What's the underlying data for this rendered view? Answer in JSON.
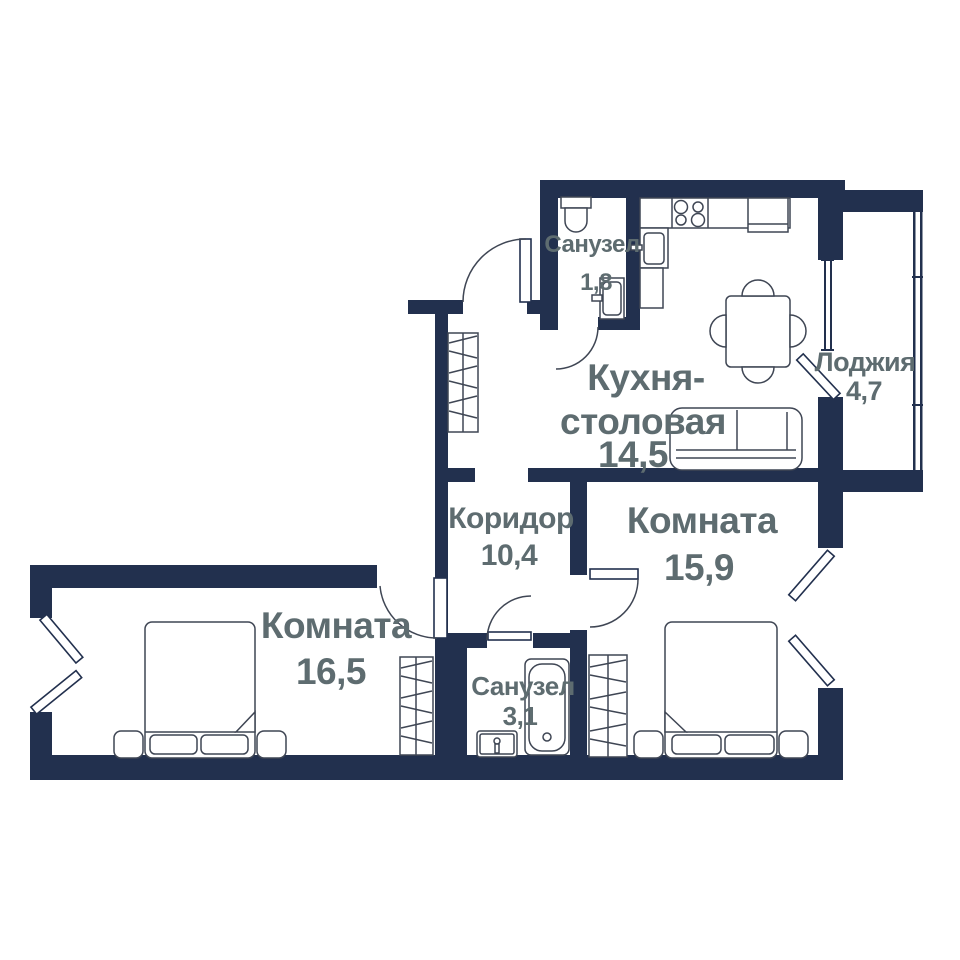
{
  "colors": {
    "wall": "#22304e",
    "label": "#5e6c70",
    "background": "#ffffff",
    "furniture_line": "#3f4654"
  },
  "rooms": [
    {
      "id": "bathroom-top",
      "name": "Санузел",
      "area": "1,8"
    },
    {
      "id": "kitchen-dining",
      "name": "Кухня-столовая",
      "name_lines": [
        "Кухня-",
        "столовая"
      ],
      "area": "14,5"
    },
    {
      "id": "loggia",
      "name": "Лоджия",
      "area": "4,7"
    },
    {
      "id": "corridor",
      "name": "Коридор",
      "area": "10,4"
    },
    {
      "id": "room-right",
      "name": "Комната",
      "area": "15,9"
    },
    {
      "id": "room-left",
      "name": "Комната",
      "area": "16,5"
    },
    {
      "id": "bathroom-bottom",
      "name": "Санузел",
      "area": "3,1"
    }
  ],
  "icons": [
    "toilet-icon",
    "washbasin-icon",
    "stove-icon",
    "fridge-icon",
    "kitchen-sink-icon",
    "dining-table-icon",
    "chair-icon",
    "sofa-icon",
    "wardrobe-icon",
    "bed-icon",
    "nightstand-icon",
    "bathtub-icon",
    "door-arc-icon",
    "window-icon",
    "balcony-door-icon"
  ]
}
